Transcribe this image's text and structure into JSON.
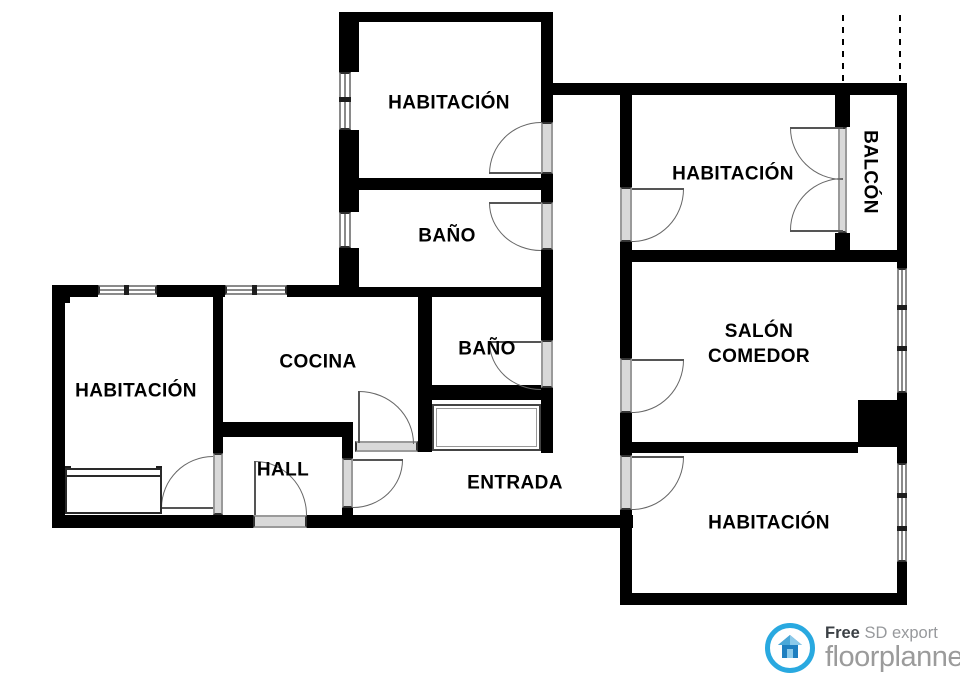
{
  "plan": {
    "canvas": {
      "width": 960,
      "height": 679,
      "background": "#ffffff",
      "wall_color": "#000000"
    },
    "rooms": [
      {
        "label": "HABITACIÓN",
        "x": 449,
        "y": 103
      },
      {
        "label": "BAÑO",
        "x": 447,
        "y": 236
      },
      {
        "label": "HABITACIÓN",
        "x": 733,
        "y": 174
      },
      {
        "label": "BALCÓN",
        "x": 870,
        "y": 172,
        "rotate": true
      },
      {
        "label": "SALÓN COMEDOR",
        "lines": [
          "SALÓN",
          "COMEDOR"
        ],
        "x": 759,
        "y": 344
      },
      {
        "label": "COCINA",
        "x": 318,
        "y": 362
      },
      {
        "label": "BAÑO",
        "x": 487,
        "y": 349
      },
      {
        "label": "HABITACIÓN",
        "x": 136,
        "y": 391
      },
      {
        "label": "HALL",
        "x": 283,
        "y": 470
      },
      {
        "label": "ENTRADA",
        "x": 515,
        "y": 483
      },
      {
        "label": "HABITACIÓN",
        "x": 769,
        "y": 523
      }
    ],
    "walls": [
      [
        339,
        12,
        213,
        10
      ],
      [
        339,
        12,
        20,
        60
      ],
      [
        339,
        130,
        20,
        48
      ],
      [
        541,
        12,
        12,
        110
      ],
      [
        541,
        174,
        12,
        28
      ],
      [
        541,
        250,
        12,
        90
      ],
      [
        541,
        393,
        12,
        60
      ],
      [
        339,
        178,
        214,
        12
      ],
      [
        339,
        190,
        20,
        22
      ],
      [
        339,
        248,
        20,
        49
      ],
      [
        52,
        285,
        46,
        12
      ],
      [
        157,
        285,
        68,
        12
      ],
      [
        287,
        285,
        54,
        12
      ],
      [
        351,
        287,
        202,
        10
      ],
      [
        52,
        285,
        18,
        18
      ],
      [
        52,
        285,
        13,
        243
      ],
      [
        52,
        515,
        201,
        13
      ],
      [
        307,
        515,
        326,
        13
      ],
      [
        213,
        295,
        10,
        158
      ],
      [
        213,
        422,
        140,
        15
      ],
      [
        342,
        437,
        11,
        21
      ],
      [
        342,
        508,
        11,
        7
      ],
      [
        418,
        290,
        14,
        162
      ],
      [
        418,
        385,
        135,
        15
      ],
      [
        541,
        83,
        366,
        12
      ],
      [
        620,
        95,
        12,
        92
      ],
      [
        620,
        242,
        12,
        116
      ],
      [
        620,
        413,
        12,
        42
      ],
      [
        620,
        510,
        12,
        95
      ],
      [
        620,
        250,
        287,
        12
      ],
      [
        835,
        95,
        15,
        32
      ],
      [
        835,
        233,
        15,
        17
      ],
      [
        897,
        83,
        10,
        185
      ],
      [
        897,
        393,
        10,
        70
      ],
      [
        897,
        562,
        10,
        43
      ],
      [
        858,
        400,
        49,
        47
      ],
      [
        620,
        442,
        238,
        11
      ],
      [
        620,
        593,
        287,
        12
      ]
    ],
    "windows": [
      {
        "x": 339,
        "y": 72,
        "w": 12,
        "h": 58,
        "dir": "v"
      },
      {
        "x": 339,
        "y": 212,
        "w": 12,
        "h": 36,
        "dir": "v"
      },
      {
        "x": 98,
        "y": 285,
        "w": 59,
        "h": 10,
        "dir": "h"
      },
      {
        "x": 225,
        "y": 285,
        "w": 62,
        "h": 10,
        "dir": "h"
      },
      {
        "x": 897,
        "y": 268,
        "w": 10,
        "h": 125,
        "dir": "v"
      },
      {
        "x": 897,
        "y": 463,
        "w": 10,
        "h": 99,
        "dir": "v"
      }
    ],
    "blocks": [
      [
        339,
        97,
        12,
        5
      ],
      [
        124,
        285,
        5,
        10
      ],
      [
        252,
        285,
        5,
        10
      ],
      [
        897,
        305,
        10,
        5
      ],
      [
        897,
        346,
        10,
        5
      ],
      [
        897,
        493,
        10,
        5
      ],
      [
        897,
        526,
        10,
        5
      ],
      [
        65,
        466,
        6,
        10
      ],
      [
        156,
        466,
        6,
        10
      ]
    ],
    "doors": {
      "thresholds": [
        {
          "x": 541,
          "y": 122,
          "w": 12,
          "h": 52,
          "dir": "v"
        },
        {
          "x": 541,
          "y": 202,
          "w": 12,
          "h": 48,
          "dir": "v"
        },
        {
          "x": 541,
          "y": 340,
          "w": 12,
          "h": 48,
          "dir": "v"
        },
        {
          "x": 213,
          "y": 453,
          "w": 10,
          "h": 62,
          "dir": "v"
        },
        {
          "x": 342,
          "y": 458,
          "w": 11,
          "h": 50,
          "dir": "v"
        },
        {
          "x": 355,
          "y": 441,
          "w": 63,
          "h": 11,
          "dir": "h"
        },
        {
          "x": 620,
          "y": 187,
          "w": 12,
          "h": 55,
          "dir": "v"
        },
        {
          "x": 620,
          "y": 358,
          "w": 12,
          "h": 55,
          "dir": "v"
        },
        {
          "x": 620,
          "y": 455,
          "w": 12,
          "h": 55,
          "dir": "v"
        },
        {
          "x": 253,
          "y": 515,
          "w": 54,
          "h": 13,
          "dir": "h"
        },
        {
          "x": 838,
          "y": 127,
          "w": 9,
          "h": 106,
          "dir": "v"
        }
      ],
      "leaves": [
        [
          489,
          172,
          52,
          2
        ],
        [
          489,
          202,
          52,
          2
        ],
        [
          489,
          341,
          52,
          2
        ],
        [
          161,
          507,
          52,
          2
        ],
        [
          353,
          459,
          50,
          2
        ],
        [
          358,
          391,
          2,
          52
        ],
        [
          632,
          188,
          52,
          2
        ],
        [
          632,
          359,
          52,
          2
        ],
        [
          632,
          456,
          52,
          2
        ],
        [
          254,
          461,
          2,
          54
        ],
        [
          790,
          127,
          53,
          2
        ],
        [
          790,
          230,
          53,
          2
        ]
      ],
      "arcs": [
        {
          "x": 489,
          "y": 122,
          "w": 52,
          "h": 52,
          "corner": "tl"
        },
        {
          "x": 489,
          "y": 203,
          "w": 52,
          "h": 48,
          "corner": "bl"
        },
        {
          "x": 489,
          "y": 342,
          "w": 52,
          "h": 48,
          "corner": "bl"
        },
        {
          "x": 161,
          "y": 456,
          "w": 52,
          "h": 52,
          "corner": "tl"
        },
        {
          "x": 353,
          "y": 460,
          "w": 50,
          "h": 48,
          "corner": "br"
        },
        {
          "x": 359,
          "y": 391,
          "w": 55,
          "h": 53,
          "corner": "tr"
        },
        {
          "x": 632,
          "y": 189,
          "w": 52,
          "h": 53,
          "corner": "br"
        },
        {
          "x": 632,
          "y": 360,
          "w": 52,
          "h": 53,
          "corner": "br"
        },
        {
          "x": 632,
          "y": 457,
          "w": 52,
          "h": 53,
          "corner": "br"
        },
        {
          "x": 255,
          "y": 461,
          "w": 52,
          "h": 54,
          "corner": "tr"
        },
        {
          "x": 790,
          "y": 128,
          "w": 53,
          "h": 52,
          "corner": "bl"
        },
        {
          "x": 790,
          "y": 178,
          "w": 53,
          "h": 52,
          "corner": "tl"
        }
      ]
    },
    "dashed_lines": [
      {
        "x": 842,
        "y": 15,
        "h": 68
      },
      {
        "x": 899,
        "y": 15,
        "h": 68
      }
    ],
    "furniture": [
      {
        "name": "bed",
        "type": "bed",
        "x": 65,
        "y": 468,
        "w": 97,
        "h": 46
      },
      {
        "name": "built-in-closet",
        "type": "closet",
        "x": 432,
        "y": 404,
        "w": 109,
        "h": 47
      }
    ]
  },
  "logo": {
    "free_label": "Free",
    "sd_label": "SD export",
    "brand": "floorplanner",
    "accent_color": "#29a9e0",
    "brand_text_color": "#9b9b9b"
  }
}
